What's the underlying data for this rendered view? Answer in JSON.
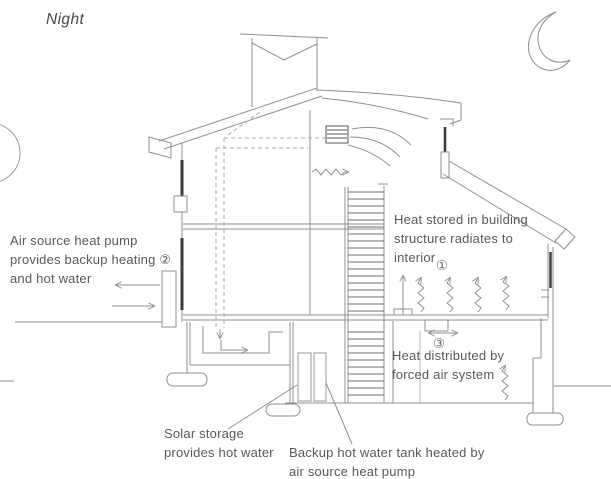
{
  "scene": {
    "title": "Night",
    "type": "house-cross-section-heating-diagram"
  },
  "labels": {
    "heat_pump": "Air source heat pump\nprovides backup heating ②\nand hot water",
    "heat_stored": "Heat stored in building\nstructure radiates to\ninterior",
    "heat_stored_marker": "①",
    "heat_distributed": "Heat distributed by\nforced air system",
    "heat_distributed_marker": "③",
    "solar_storage": "Solar storage\nprovides hot water",
    "backup_tank": "Backup hot water tank heated by\nair source heat pump"
  },
  "icons": {
    "moon": "crescent-moon-icon",
    "left_edge": "partial-circle-icon",
    "heat_waves": "squiggle-heat-arrow",
    "vent": "vent-grille-icon"
  },
  "colors": {
    "line": "#8f8f8f",
    "glazing": "#3c3c3c",
    "dashed_duct": "#a9a9a9",
    "text": "#55595c",
    "background": "#ffffff"
  }
}
